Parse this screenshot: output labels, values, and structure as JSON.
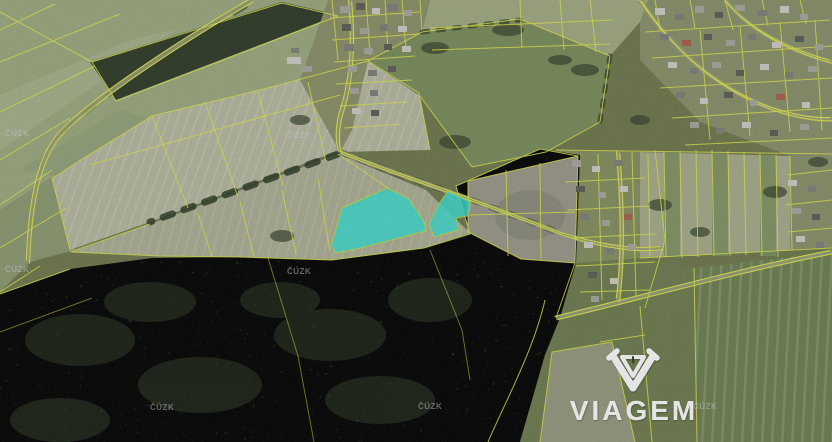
{
  "map": {
    "provider_watermark": {
      "text": "ČÚZK",
      "color": "rgba(210,216,218,0.5)",
      "positions": [
        [
          5,
          136
        ],
        [
          287,
          138
        ],
        [
          5,
          272
        ],
        [
          287,
          274
        ],
        [
          150,
          410
        ],
        [
          418,
          409
        ],
        [
          693,
          409
        ]
      ]
    },
    "brand": {
      "name": "VIAGEM",
      "color": "#ffffff"
    },
    "highlight_parcels": {
      "fill": "#3fded2",
      "stroke": "#c6de3a",
      "opacity": 0.88,
      "polygons": [
        [
          [
            387,
            188
          ],
          [
            408,
            198
          ],
          [
            424,
            221
          ],
          [
            426,
            231
          ],
          [
            357,
            249
          ],
          [
            336,
            253
          ],
          [
            331,
            246
          ],
          [
            342,
            208
          ]
        ],
        [
          [
            448,
            191
          ],
          [
            459,
            196
          ],
          [
            471,
            202
          ],
          [
            468,
            216
          ],
          [
            456,
            218
          ],
          [
            459,
            230
          ],
          [
            434,
            237
          ],
          [
            429,
            224
          ],
          [
            436,
            209
          ],
          [
            443,
            198
          ]
        ]
      ]
    },
    "palette": {
      "parcel_line": "#dfe84a",
      "forest": "#3b4a2e",
      "field_tan": "#b7baa2",
      "field_green": "#7b8e5c",
      "base": "#6e794c"
    },
    "houses": {
      "fills": [
        "#cfcfc7",
        "#a8a8a0",
        "#80807a",
        "#5d5d57",
        "#a8604b"
      ],
      "rects": [
        [
          340,
          6,
          10,
          7,
          1
        ],
        [
          356,
          3,
          9,
          7,
          3
        ],
        [
          372,
          8,
          8,
          6,
          0
        ],
        [
          388,
          4,
          10,
          7,
          2
        ],
        [
          404,
          10,
          8,
          6,
          1
        ],
        [
          342,
          24,
          9,
          7,
          3
        ],
        [
          360,
          28,
          10,
          6,
          1
        ],
        [
          380,
          24,
          8,
          7,
          2
        ],
        [
          398,
          26,
          9,
          6,
          0
        ],
        [
          344,
          44,
          10,
          7,
          2
        ],
        [
          364,
          48,
          9,
          6,
          1
        ],
        [
          384,
          44,
          8,
          6,
          3
        ],
        [
          402,
          46,
          9,
          6,
          0
        ],
        [
          348,
          66,
          9,
          6,
          1
        ],
        [
          368,
          70,
          9,
          6,
          2
        ],
        [
          388,
          66,
          8,
          6,
          3
        ],
        [
          350,
          88,
          9,
          6,
          1
        ],
        [
          370,
          90,
          8,
          6,
          2
        ],
        [
          352,
          108,
          9,
          6,
          0
        ],
        [
          371,
          110,
          8,
          6,
          3
        ],
        [
          655,
          8,
          10,
          7,
          0
        ],
        [
          675,
          14,
          9,
          6,
          2
        ],
        [
          695,
          6,
          9,
          7,
          1
        ],
        [
          715,
          12,
          8,
          6,
          3
        ],
        [
          735,
          5,
          10,
          6,
          1
        ],
        [
          758,
          10,
          9,
          6,
          2
        ],
        [
          780,
          6,
          9,
          7,
          0
        ],
        [
          800,
          14,
          8,
          6,
          1
        ],
        [
          660,
          34,
          9,
          6,
          2
        ],
        [
          682,
          40,
          9,
          6,
          4
        ],
        [
          704,
          34,
          8,
          6,
          3
        ],
        [
          726,
          40,
          9,
          6,
          1
        ],
        [
          748,
          34,
          8,
          6,
          2
        ],
        [
          772,
          42,
          9,
          6,
          0
        ],
        [
          795,
          36,
          9,
          6,
          3
        ],
        [
          815,
          44,
          8,
          6,
          1
        ],
        [
          668,
          62,
          9,
          6,
          0
        ],
        [
          690,
          68,
          8,
          6,
          2
        ],
        [
          712,
          62,
          9,
          6,
          1
        ],
        [
          736,
          70,
          8,
          6,
          3
        ],
        [
          760,
          64,
          9,
          6,
          0
        ],
        [
          785,
          72,
          8,
          6,
          2
        ],
        [
          808,
          66,
          9,
          6,
          1
        ],
        [
          676,
          92,
          9,
          6,
          2
        ],
        [
          700,
          98,
          8,
          6,
          0
        ],
        [
          724,
          92,
          9,
          6,
          3
        ],
        [
          750,
          100,
          8,
          6,
          1
        ],
        [
          776,
          94,
          9,
          6,
          4
        ],
        [
          802,
          102,
          8,
          6,
          0
        ],
        [
          690,
          122,
          9,
          6,
          1
        ],
        [
          716,
          128,
          8,
          6,
          2
        ],
        [
          742,
          122,
          9,
          6,
          0
        ],
        [
          770,
          130,
          8,
          6,
          3
        ],
        [
          800,
          124,
          9,
          6,
          1
        ],
        [
          572,
          160,
          9,
          7,
          1
        ],
        [
          592,
          166,
          8,
          6,
          0
        ],
        [
          614,
          160,
          9,
          6,
          2
        ],
        [
          576,
          186,
          9,
          6,
          3
        ],
        [
          598,
          192,
          8,
          6,
          1
        ],
        [
          620,
          186,
          8,
          6,
          0
        ],
        [
          580,
          214,
          9,
          6,
          2
        ],
        [
          602,
          220,
          8,
          6,
          1
        ],
        [
          624,
          214,
          8,
          6,
          4
        ],
        [
          584,
          242,
          9,
          6,
          0
        ],
        [
          606,
          248,
          8,
          6,
          2
        ],
        [
          628,
          244,
          8,
          6,
          1
        ],
        [
          588,
          272,
          9,
          6,
          3
        ],
        [
          610,
          278,
          8,
          6,
          0
        ],
        [
          591,
          296,
          8,
          6,
          1
        ],
        [
          788,
          180,
          9,
          6,
          0
        ],
        [
          808,
          186,
          8,
          6,
          2
        ],
        [
          792,
          208,
          9,
          6,
          1
        ],
        [
          812,
          214,
          8,
          6,
          3
        ],
        [
          796,
          236,
          9,
          6,
          0
        ],
        [
          816,
          242,
          8,
          6,
          2
        ],
        [
          287,
          57,
          14,
          7,
          0
        ],
        [
          301,
          66,
          11,
          6,
          1
        ],
        [
          291,
          48,
          8,
          5,
          2
        ]
      ]
    }
  }
}
